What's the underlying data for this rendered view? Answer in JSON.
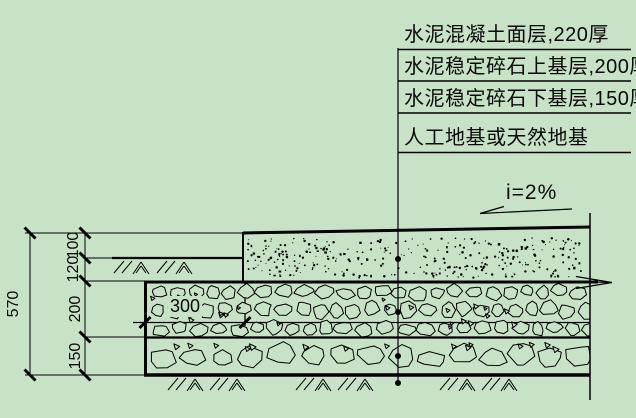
{
  "diagram": {
    "background": "#c7e2c7",
    "line_color": "#000000",
    "callouts": [
      "水泥混凝土面层,220厚",
      "水泥稳定碎石上基层,200厚",
      "水泥稳定碎石下基层,150厚",
      "人工地基或天然地基"
    ],
    "slope_label": "i=2%",
    "dimensions": {
      "overall_height": "570",
      "surface_above_ground": "100",
      "surface_below_ground": "120",
      "upper_base": "200",
      "lower_base": "150",
      "base_extension": "300"
    }
  }
}
